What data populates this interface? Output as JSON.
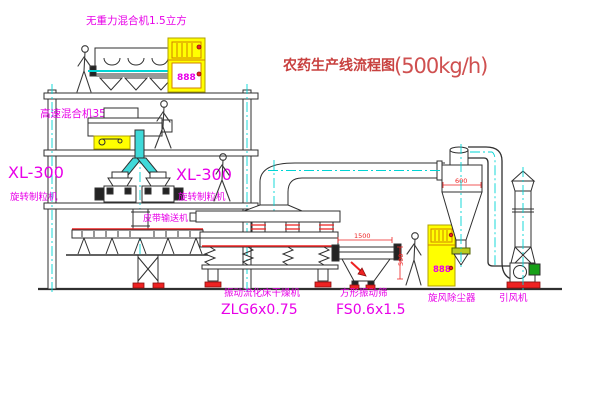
{
  "title": {
    "cn": "农药生产线流程图",
    "capacity": "(500kg/h)"
  },
  "labels": {
    "gravity_mixer": "无重力混合机1.5立方",
    "high_speed_mixer": "高速混合机350",
    "granulator_left_model": "XL-300",
    "granulator_left_name": "旋转制粒机",
    "granulator_right_model": "XL-300",
    "granulator_right_name": "旋转制粒机",
    "belt_conveyor": "皮带输送机",
    "dryer_name": "振动流化床干燥机",
    "dryer_model": "ZLG6x0.75",
    "screen_name": "方形振动筛",
    "screen_model": "FS0.6x1.5",
    "cyclone_name": "旋风除尘器",
    "fan_name": "引风机"
  },
  "dimensions": {
    "cyclone_width": "600",
    "screen_length": "1500",
    "screen_height": "500"
  },
  "control_cabinets": {
    "display_left": "888",
    "display_right": "888"
  },
  "colors": {
    "label_magenta": "#e800e8",
    "title_red": "#c8403f",
    "line_dark": "#2f2f2f",
    "centerline_cyan": "#00d4d4",
    "cabinet_yellow": "#ffff00",
    "accent_red": "#ee2222",
    "motor_green": "#18a018"
  }
}
